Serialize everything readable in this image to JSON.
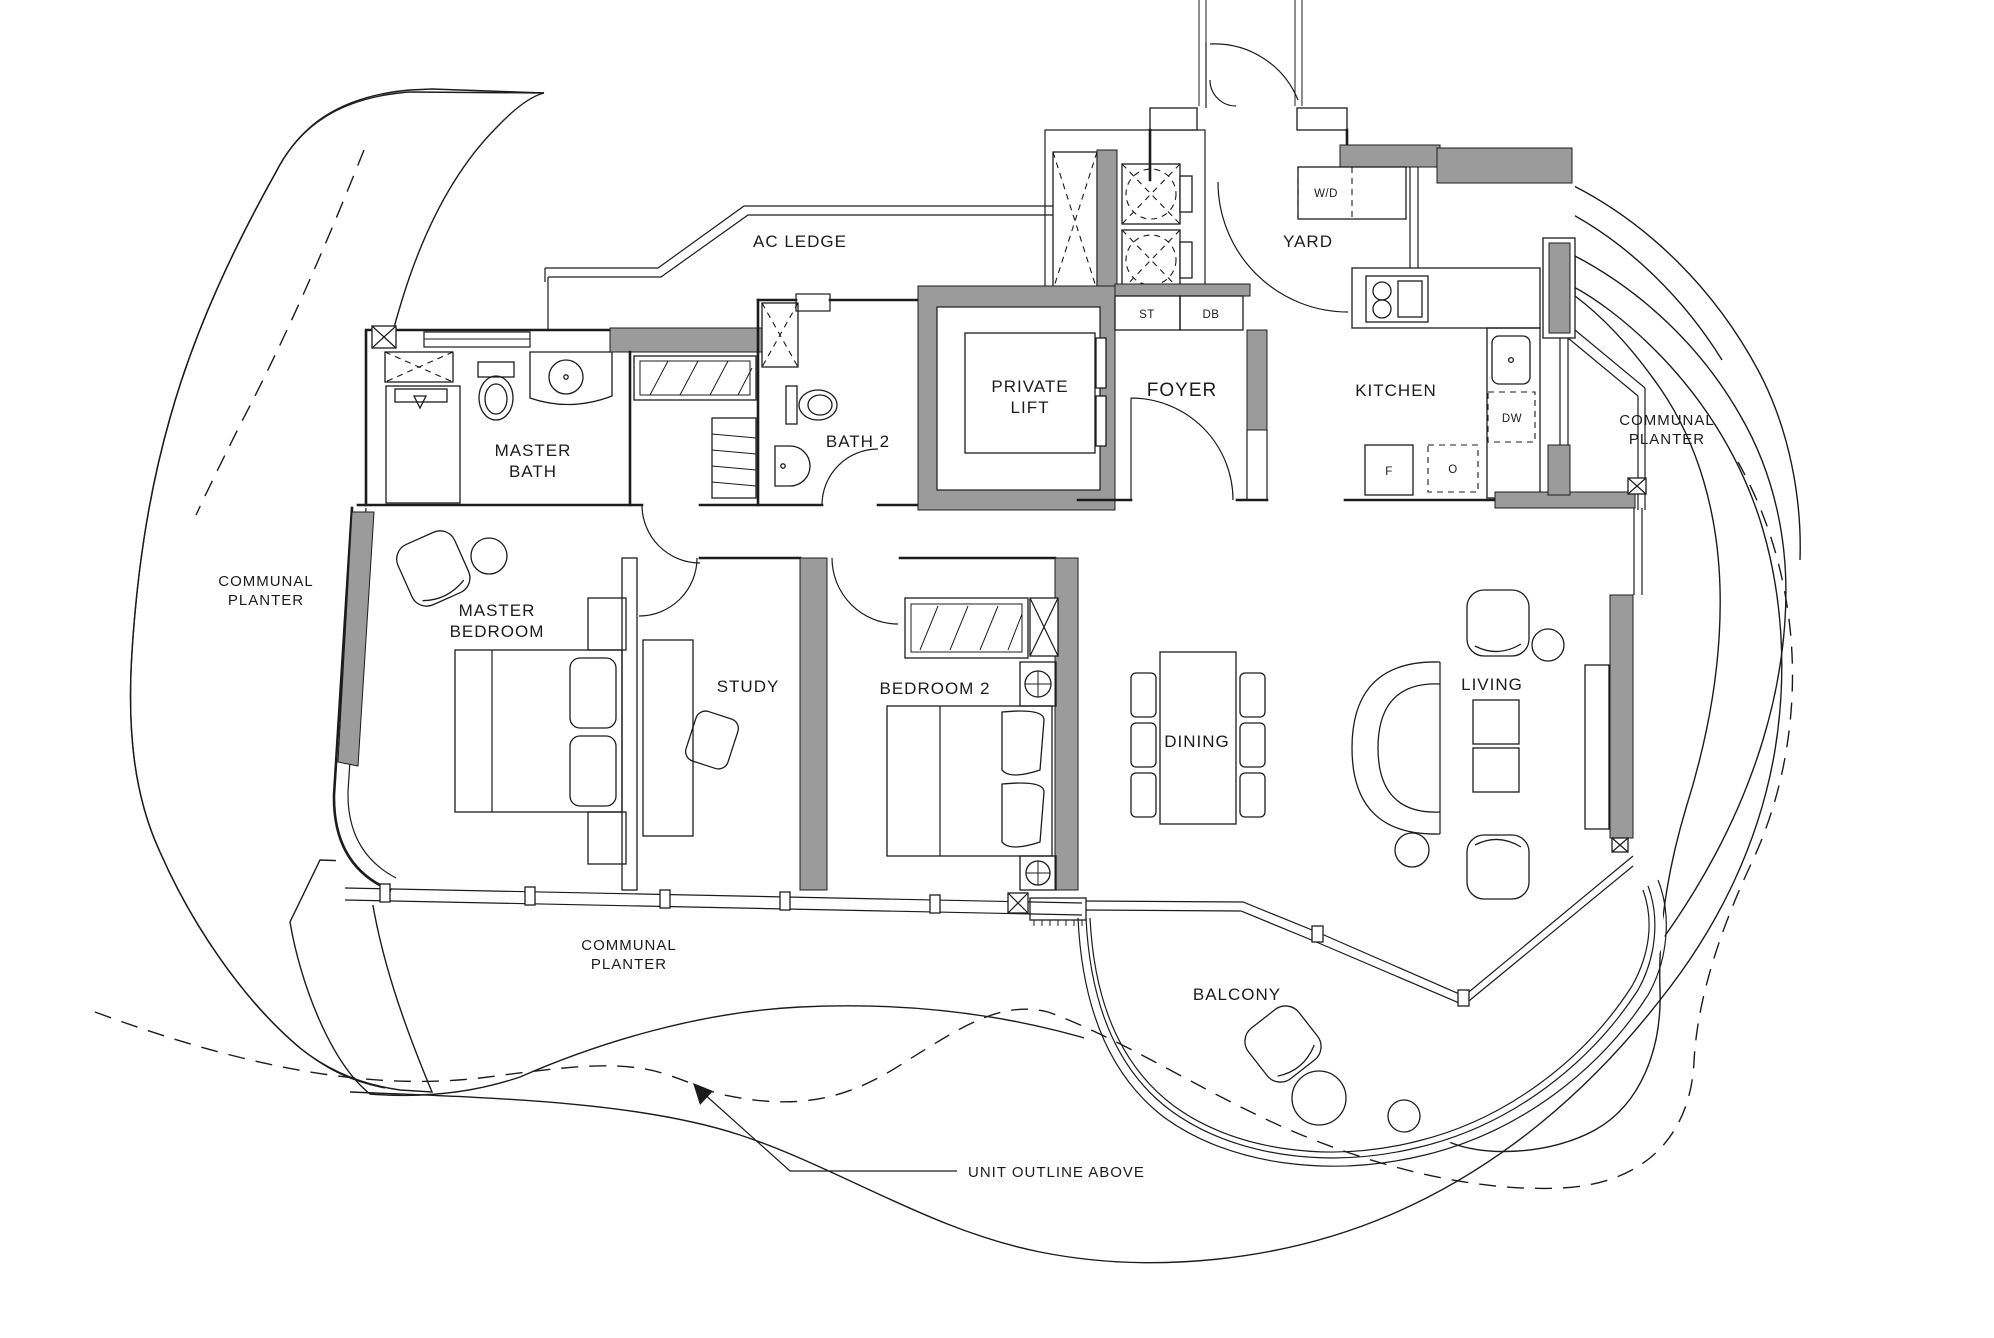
{
  "title": "Apartment unit floor plan",
  "colors": {
    "wall_gray": "#9b9b9b",
    "line": "#1c1c1c",
    "background": "#ffffff"
  },
  "labels": {
    "ac_ledge": "AC LEDGE",
    "yard": "YARD",
    "washer_dryer": "W/D",
    "private_lift_line1": "PRIVATE",
    "private_lift_line2": "LIFT",
    "foyer": "FOYER",
    "storage_cabinet": "ST",
    "distribution_board": "DB",
    "kitchen": "KITCHEN",
    "dishwasher": "DW",
    "fridge": "F",
    "oven": "O",
    "master_bath_line1": "MASTER",
    "master_bath_line2": "BATH",
    "bath2": "BATH 2",
    "master_bedroom_line1": "MASTER",
    "master_bedroom_line2": "BEDROOM",
    "study": "STUDY",
    "bedroom2": "BEDROOM 2",
    "dining": "DINING",
    "living": "LIVING",
    "balcony": "BALCONY",
    "communal_planter_line1": "COMMUNAL",
    "communal_planter_line2": "PLANTER",
    "unit_outline_above": "UNIT OUTLINE ABOVE"
  }
}
